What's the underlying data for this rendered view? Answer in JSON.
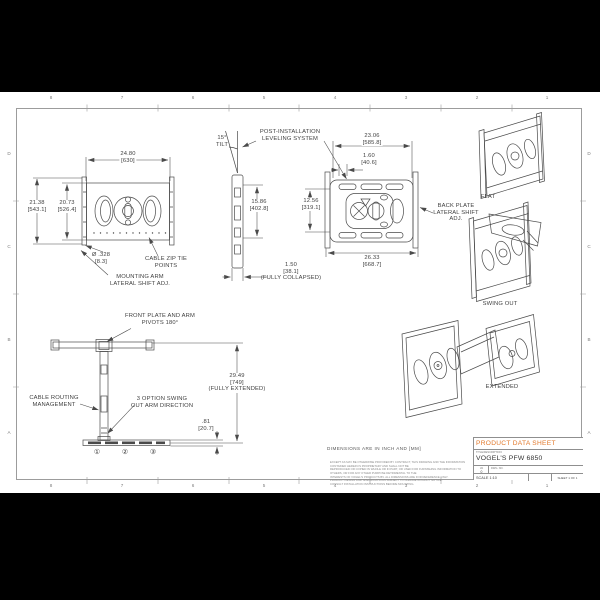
{
  "sheet": {
    "border": {
      "cols": [
        "8",
        "7",
        "6",
        "5",
        "4",
        "3",
        "2",
        "1"
      ],
      "rows": [
        "D",
        "C",
        "B",
        "A"
      ]
    },
    "note": "DIMENSIONS ARE IN INCH AND [MM]",
    "fine_print": [
      "EXCEPT AS MAY BE OTHERWISE PROVIDED BY CONTRACT, THIS DRAWING AND THE INFORMATION CONTAINED HEREIN IS PROPRIETARY AND SHALL NOT BE",
      "REPRODUCED OR COPIED IN WHOLE OR IN PART, OR USED FOR FURNISHING INFORMATION TO OTHERS, OR FOR ANY OTHER PURPOSE DETRIMENTAL TO THE",
      "INTERESTS OF VOGEL'S PRODUCTS BV. ALL DIMENSIONS ARE FOR REFERENCE ONLY.",
      "PRODUCT DESIGN AND SPECIFICATIONS SUBJECT TO CHANGE WITHOUT NOTICE.",
      "CONSULT INSTALLATION INSTRUCTIONS BEFORE MOUNTING."
    ]
  },
  "views": {
    "front": {
      "dim_width_in": "24.80",
      "dim_width_mm": "[630]",
      "dim_height_outer_in": "21.38",
      "dim_height_outer_mm": "[543.1]",
      "dim_height_inner_in": "20.73",
      "dim_height_inner_mm": "[526.4]",
      "dim_hole_d": "Ø .328",
      "dim_hole_mm": "[8.3]",
      "label_zip_1": "CABLE ZIP TIE",
      "label_zip_2": "POINTS",
      "label_mount_1": "MOUNTING ARM",
      "label_mount_2": "LATERAL SHIFT ADJ."
    },
    "side": {
      "tilt_1": "15°",
      "tilt_2": "TILT",
      "post_1": "POST-INSTALLATION",
      "post_2": "LEVELING SYSTEM",
      "dim_height_in": "15.86",
      "dim_height_mm": "[402.8]",
      "collapsed_in": "1.50",
      "collapsed_mm": "[38.1]",
      "collapsed_note": "(FULLY COLLAPSED)"
    },
    "back": {
      "dim_width_in": "23.06",
      "dim_width_mm": "[585.8]",
      "dim_offset_in": "1.60",
      "dim_offset_mm": "[40.6]",
      "dim_height_in": "12.56",
      "dim_height_mm": "[319.1]",
      "dim_outer_in": "26.33",
      "dim_outer_mm": "[668.7]",
      "label_adj_1": "BACK PLATE",
      "label_adj_2": "LATERAL SHIFT",
      "label_adj_3": "ADJ."
    },
    "iso": {
      "flat": "FLAT",
      "swing": "SWING OUT",
      "extended": "EXTENDED"
    },
    "top": {
      "label_pivot_1": "FRONT PLATE AND ARM",
      "label_pivot_2": "PIVOTS 180°",
      "label_cable_1": "CABLE ROUTING",
      "label_cable_2": "MANAGEMENT",
      "label_swing_1": "3 OPTION SWING",
      "label_swing_2": "OUT ARM DIRECTION",
      "extended_in": "29.49",
      "extended_mm": "[749]",
      "extended_note": "(FULLY EXTENDED)",
      "thickness_in": ".81",
      "thickness_mm": "[20.7]",
      "options": [
        "①",
        "②",
        "③"
      ]
    }
  },
  "titleblock": {
    "header": "PRODUCT DATA SHEET",
    "desc_label": "TITLE/DESCRIPTION:",
    "product": "VOGEL'S PFW 6850",
    "rev_label": "VA",
    "rev_value": "0",
    "dwg_label": "DWG. NO.",
    "scale": "SCALE 1:10",
    "sheet": "SHEET 1 OF 1"
  },
  "colors": {
    "accent": "#E2782A",
    "line": "#4A4A4A"
  }
}
